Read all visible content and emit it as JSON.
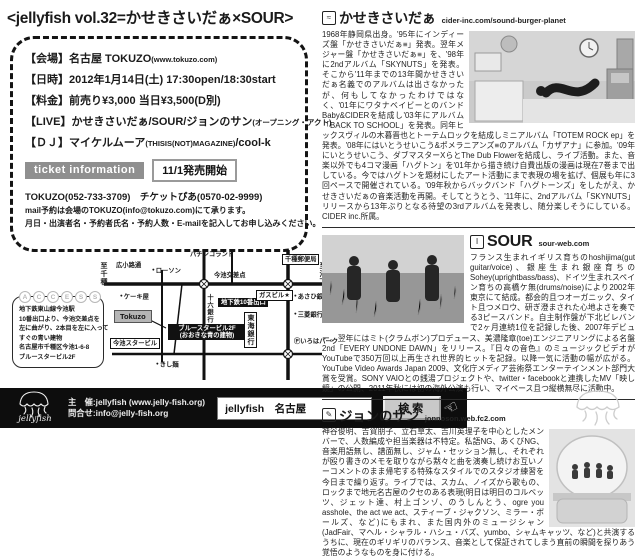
{
  "title": "<jellyfish vol.32=かせきさいだぁ×SOUR>",
  "colors": {
    "footer_bg": "#0d0d0d",
    "ticket_badge_bg": "#8f8f8f",
    "ink": "#1a1a1a"
  },
  "event": {
    "rows": [
      {
        "label": "【会場】",
        "main": "名古屋 TOKUZO",
        "small": "(www.tokuzo.com)",
        "tail": ""
      },
      {
        "label": "【日時】",
        "main": "2012年1月14日(土) 17:30open/18:30start",
        "small": "",
        "tail": ""
      },
      {
        "label": "【料金】",
        "main": "前売り¥3,000 当日¥3,500(D別)",
        "small": "",
        "tail": ""
      },
      {
        "label": "【LIVE】",
        "main": "かせきさいだぁ/SOUR/ジョンのサン",
        "small": "(オープニング・アクト)",
        "tail": ""
      },
      {
        "label": "【ＤＪ】",
        "main": "マイケルムーア",
        "small": "(THISIS(NOT)MAGAZINE)",
        "tail": "/cool-k"
      }
    ]
  },
  "ticket": {
    "badge": "ticket information",
    "release": "11/1発売開始",
    "phones": "TOKUZO(052-733-3709)　チケットぴあ(0570-02-9999)",
    "mail_line1": "mail予約は会場のTOKUZO(info@tokuzo.com)にて承ります。",
    "mail_line2": "月日・出演者名・予約者氏名・予約人数・E-mailを記入してお申し込みください。"
  },
  "access": {
    "letters": [
      "A",
      "C",
      "C",
      "E",
      "S",
      "S"
    ],
    "lines": [
      "地下鉄東山線今池駅",
      "10番出口より、今池交差点を",
      "左に曲がり、2本目を左に入って",
      "すぐの青い建物",
      "名古屋市千種区今池1-6-8",
      "ブルースタービル2F"
    ]
  },
  "map": {
    "to_chikusa": "至千種",
    "to_ikeshita": "至池下",
    "hirokoji": "広小路通",
    "lawson": "ローソン",
    "pachinko": "パチンコランド",
    "imaike_kosaten": "今池交差点",
    "post_office": "千種郵便局",
    "cake_shop": "ケーキ屋",
    "juroku_bank": "十六銀行",
    "exit10": "地下鉄10番出口",
    "gas_bldg": "ガスビル★",
    "asahi_bank": "あさひ銀行",
    "tokuzo": "Tokuzo",
    "bluestar1": "ブルースタービル2F",
    "bluestar2": "(おおきな青の建物)",
    "imaike_star": "今池スタービル",
    "tokai_bank": "東海銀行",
    "mitsubishi_bank": "三菱銀行",
    "iroha_park": "Ⓟいろはパーク",
    "kishimen": "きし麺"
  },
  "footer": {
    "organizer_line1": "主　催:jellyfish (www.jelly-fish.org)",
    "organizer_line2": "問合せ:info@jelly-fish.org",
    "logo_text": "jellyfish",
    "search_value": "jellyfish　名古屋",
    "search_button": "検索",
    "hand_icon": "☜"
  },
  "artists": [
    {
      "icon_glyph": "≈",
      "name": "かせきさいだぁ",
      "url": "cider-inc.com/sound-burger-planet",
      "bio": "1968年静岡県出身。'95年にインディーズ盤「かせきさいだぁ≡」発表。翌年メジャー盤「かせきさいだぁ≡」を、'98年に2ndアルバム「SKYNUTS」を発表。そこから'11年までの13年間かせきさいだぁ名義でのアルバムは出さなかったが、何もしてなかったわけではなく、'01年にワタナベイビーとのバンドBaby&CIDERを結成し'03年にアルバム「BACK TO SCHOOL」を発表。同年ヒックスヴィルの木暮晋也とトーテムロックを結成しミニアルバム「TOTEM ROCK ep」を発表。'08年にはいとうせいこう&ポメラニアンズ≡のアルバム「カザアナ」に参加。'09年にいとうせいこう、ダブマスターXらとThe Dub Flowerを結成し、ライブ活動。また、音楽以外でも4コマ漫画「ハグトン」を'01年から描き続け自費出版の漫画は現在7巻まで出している。今ではハグトンを題材にしたアート活動にまで表現の場を拡げ、個展も年に3回ペースで開催されている。'09年秋からバックバンド「ハグトーンズ」をしたがえ、かせきさいだぁの音楽活動を再開。そしてとうとう、'11年に、2ndアルバム「SKYNUTS」リリースから13年ぶりとなる待望の3rdアルバムを発表し、随分楽しそうにしている。CIDER inc.所属。"
    },
    {
      "icon_glyph": "Ⅰ",
      "name": "SOUR",
      "url": "sour-web.com",
      "bio": "フランス生まれイギリス育ちのhoshijima(gut guitar/voice)、銀座生まれ銀座育ちのSohey(uprightbass/bass)、ドイツ生まれスペイン育ちの高橋ケ無(drums/noise)により2002年東京にて結成。都会的且つオーガニック、タイト且つメロウ、研ぎ澄まされた心地よさを奏でる3ピースバンド。自主制作盤が下北ビレバンで2ヶ月連続1位を記録した後、2007年デビュー。翌年にはミト(クラムボン)プロデュース、美濃隆章(toe)エンジニアリングによる名盤2nd「EVERY UNDONE DAWN」をリリース。『日々の音色』のミュージックビデオがYouTubeで350万回以上再生され世界的ヒットを記録。以降一気に活動の幅が広がる。YouTube Video Awards Japan 2009、文化庁メディア芸術祭エンターテインメント部門大賞を受賞。SONY VAIOとの銭湯プロジェクトや、twitter・facebookと連携したMV「映し鏡」の公開、2011年秋には初の海外公演も行い、マイペース且つ縦横無尽に活動中。"
    },
    {
      "icon_glyph": "✎",
      "name": "ジョンのサン",
      "url": "jonnoson.web.fc2.com",
      "bio": "神谷俊明、吉賀朋子、立石草太、吉川英理子を中心としたメンバーで、人数編成や担当楽器は不特定。私語NG、あくびNG、音楽用語無し、譜面無し、ジャム・セッション無し、それぞれが殴り書きのメモを取りながら黙々と曲を演奏し続けお互いノーコメントのまま帰宅する特殊なスタイルでのスタジオ練習を今日まで繰り返す。ライブでは、スカム、ノイズから歌もの、ロックまで地元名古屋のクセのある表現(明日は明日のコルベッツ、ジェット達、村上ゴンゾ、のうしんとう、ogre you asshole、the act we act、スティーブ・ジャクソン、ミラー・ボールズ、など)にもまれ、また国内外のミュージシャン(JadFair、マヘル・シャラル・ハシュ・バズ、yumbo、シャムキャッツ、など)と共演するうちに、現在のギリギリのバランス、音楽として保証されてしまう直前の瞬間を探りあう覚悟のようなものを身に付ける。"
    }
  ]
}
